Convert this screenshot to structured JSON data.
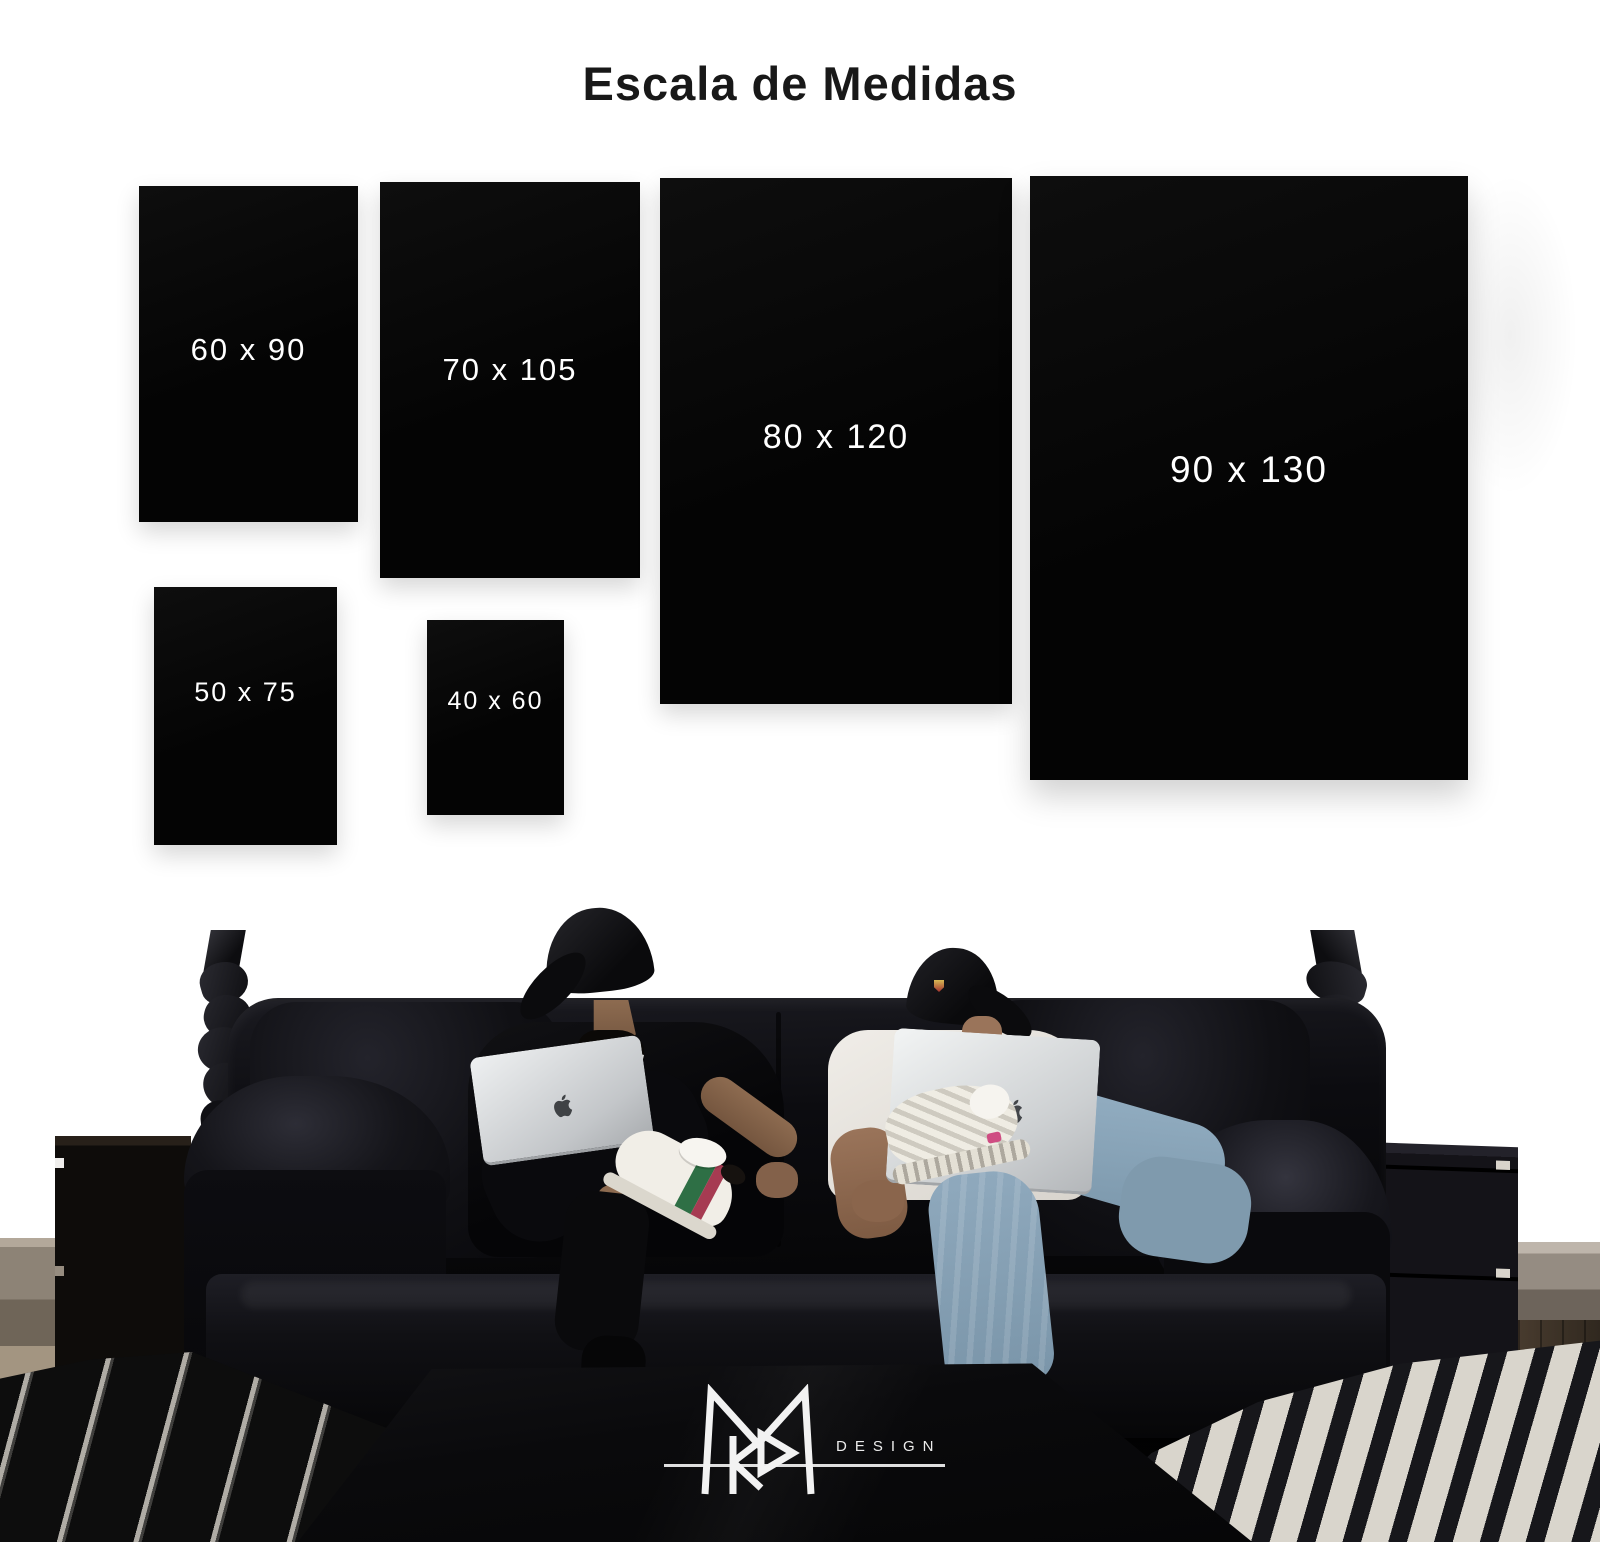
{
  "page": {
    "title": "Escala de Medidas"
  },
  "posters": [
    {
      "label": "60 x 90"
    },
    {
      "label": "70 x 105"
    },
    {
      "label": "80 x 120"
    },
    {
      "label": "90 x 130"
    },
    {
      "label": "50 x 75"
    },
    {
      "label": "40 x 60"
    }
  ],
  "brand": {
    "logo_text": "DESIGN"
  },
  "icons": {
    "laptop_logo": "apple-logo",
    "brand_monogram": "mr-monogram-icon"
  },
  "colors": {
    "wall": "#ffffff",
    "title": "#181818",
    "poster": "#040404",
    "poster_text": "#ffffff",
    "logo": "#ececec",
    "leather": "#0a0a0d",
    "jeans": "#8fa9bd"
  }
}
